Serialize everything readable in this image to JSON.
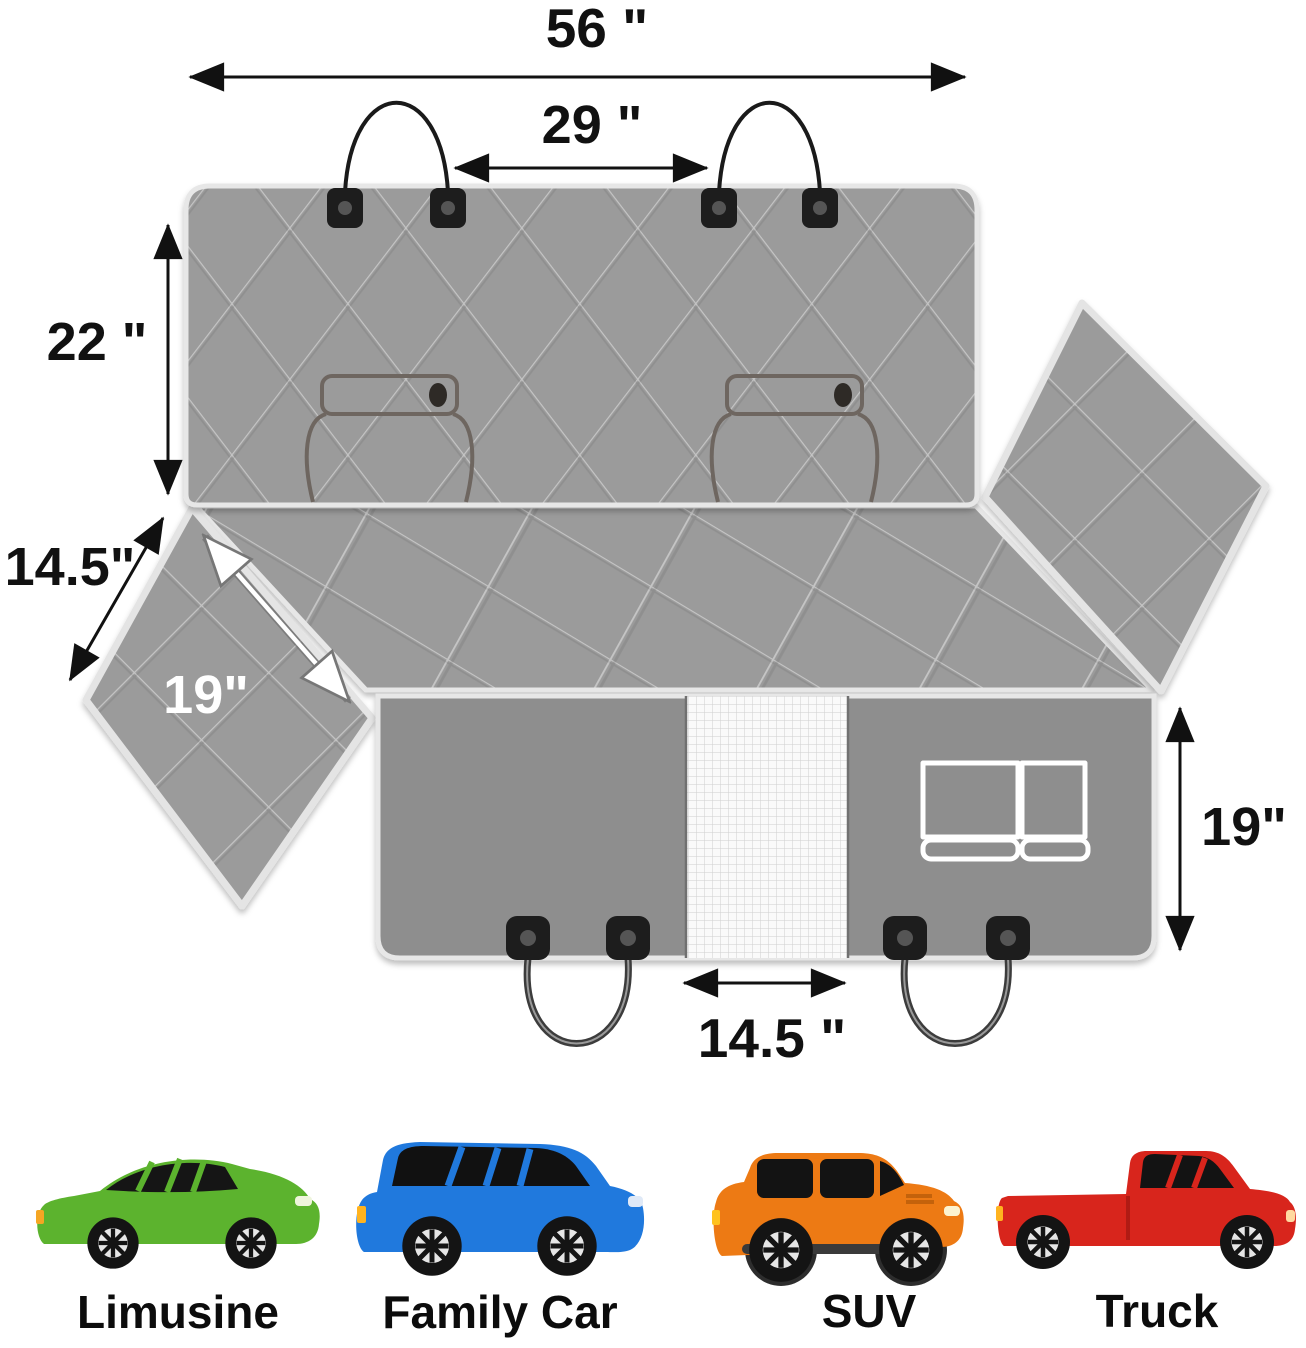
{
  "diagram": {
    "title": "dog car seat cover unfolded dimensions",
    "dimension_labels": {
      "total_width": "56 \"",
      "headrest_strap_gap": "29 \"",
      "backrest_height": "22 \"",
      "side_flap_edge": "14.5\"",
      "side_flap_diagonal": "19\"",
      "front_panel_height": "19\"",
      "mesh_window_width": "14.5 \""
    },
    "colors": {
      "quilt_gray": "#9b9b9b",
      "front_panel_gray": "#8e8e8e",
      "seam_white": "#e7e7e7",
      "buckle_black": "#1d1d1d",
      "strap_dark": "#3c3c3c",
      "mesh_white": "#fafafa",
      "pocket_outline": "#ffffff",
      "label_black": "#111111",
      "label_white": "#ffffff"
    },
    "parts": {
      "mesh_window": "mesh window",
      "storage_pocket": "storage pocket",
      "seat_belt_openings": 2,
      "headrest_straps": 2,
      "seat_anchor_straps": 2
    }
  },
  "vehicles": {
    "items": [
      {
        "label": "Limusine",
        "color": "#5cb32e",
        "accent": "#499e22"
      },
      {
        "label": "Family Car",
        "color": "#2079dd",
        "accent": "#1a63c0"
      },
      {
        "label": "SUV",
        "color": "#ed7a14",
        "accent": "#d4690c"
      },
      {
        "label": "Truck",
        "color": "#d8251c",
        "accent": "#b01b14"
      }
    ]
  }
}
